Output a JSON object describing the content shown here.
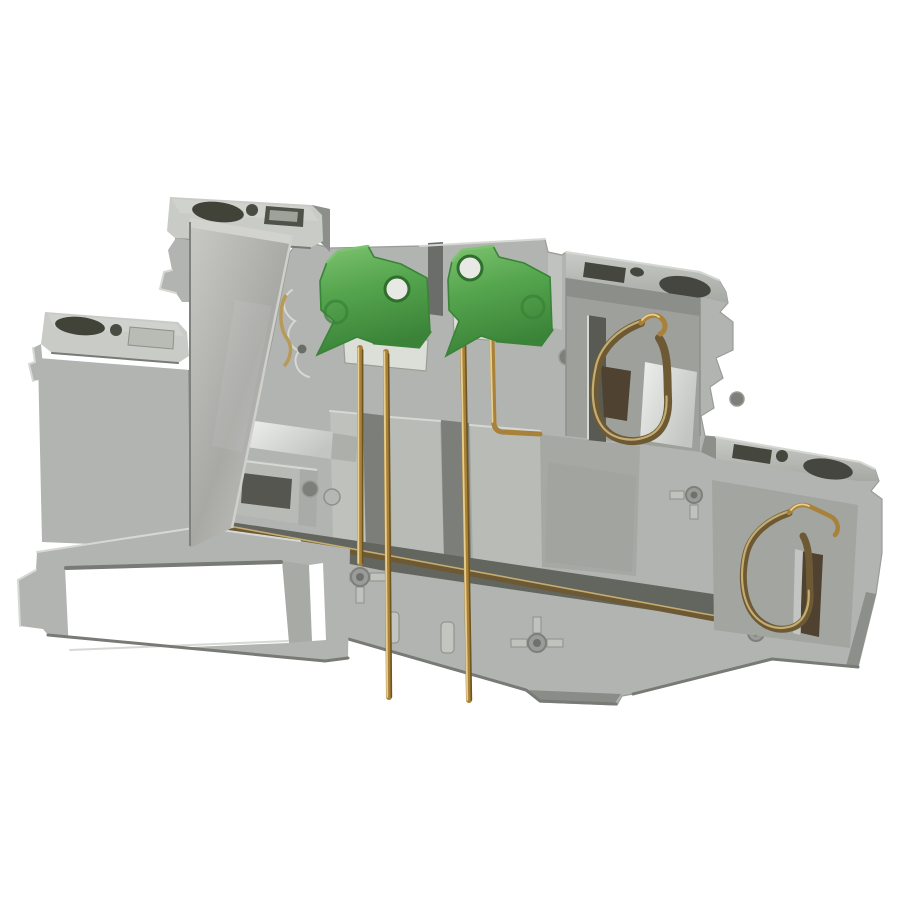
{
  "image": {
    "kind": "product-photo",
    "subject": "Multi-level DIN-rail terminal block with test disconnect plugs",
    "alt": "Gray two-level DIN rail spring-clamp terminal block on a white background, fitted with two green test disconnect plugs with brass pins, bronze tension-clamp springs, silver current bars, a diagonal gray partition cover plate and a DIN-rail mounting foot with a rectangular opening."
  },
  "palette": {
    "bg": "#ffffff",
    "housing_light": "#c9cbc7",
    "housing_mid": "#b2b4b1",
    "housing_base": "#a6a8a4",
    "housing_dark": "#8d8f8b",
    "housing_shadow": "#787a76",
    "recess": "#9da09b",
    "band_dark": "#63655f",
    "opening_dark": "#45473f",
    "opening_mid": "#6b6d68",
    "plate_light": "#c9cac6",
    "plate_mid": "#a8a9a5",
    "plate_edge_dark": "#7f817c",
    "silver_light": "#eef0ed",
    "silver_mid": "#c3c5c2",
    "silver_dark": "#989a96",
    "green_main": "#55a54e",
    "green_light": "#7ec36f",
    "green_dark": "#3a8338",
    "hole_ring_green": "#2f6f2d",
    "plug_hole_fill": "#e8e9e5",
    "brass_light": "#e8cf8e",
    "brass_mid": "#a8813a",
    "brass_dark": "#6e5420",
    "bronze_light": "#c3ad72",
    "bronze_mid": "#6d5a35",
    "bronze_dark": "#4f4230",
    "metal_white": "#dcded8"
  }
}
